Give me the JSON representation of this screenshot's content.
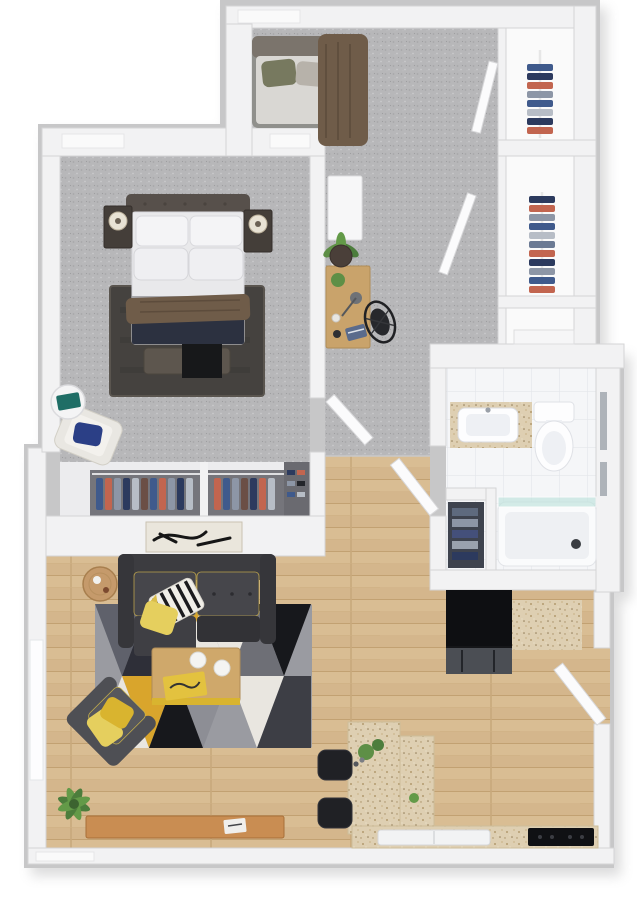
{
  "scene": {
    "title": "3D Floor Plan - One-Bedroom Apartment (top-down dollhouse render)",
    "style": "photoreal 3D top view, white cut walls with gray rim, no text labels visible",
    "background": "#ffffff"
  },
  "palette": {
    "outer_wall": "#c7c7c8",
    "wall": "#f2f2f3",
    "wall_edge": "#d4d4d6",
    "carpet": "#b7b7b9",
    "wood_floor": "#d9bd93",
    "tile": "#f5f6f8",
    "granite": "#decfb2",
    "sofa": "#3c3c40",
    "armchair_gray": "#4e4f54",
    "accent_yellow": "#d9b42f",
    "pillow_yellow": "#e5cf5e",
    "rug_gray": "#9a9ba1",
    "rug_dark": "#5f616b",
    "rug_black": "#17181c",
    "rug_white": "#e9e6e0",
    "navy": "#2c3140",
    "headboard": "#57504b",
    "bed_throw": "#6f5c49",
    "appliance_black": "#151619",
    "stool_black": "#202125",
    "plant_green": "#5e8f46",
    "clothes_blue": "#3f5a8c",
    "clothes_red": "#c2654f",
    "clothes_gray": "#8d96a6",
    "pillow_navy": "#2b3f86",
    "glass": "#bfe3dd",
    "wood_furniture": "#c9a36b",
    "console_wood": "#c98d52"
  },
  "rooms": [
    {
      "id": "bedroom",
      "name": "Bedroom",
      "floor": "gray carpet",
      "furniture": [
        "double bed with tufted headboard, four white pillows, gray band and dark navy blanket",
        "brown throw blanket across bed",
        "upholstered bench with black runner at foot of bed",
        "dark area rug under bed",
        "left nightstand with basket lamp",
        "right nightstand with basket lamp",
        "cream accent chair with navy pillow",
        "round white side table with teal book"
      ]
    },
    {
      "id": "den",
      "name": "Den / Home Office",
      "floor": "gray carpet",
      "furniture": [
        "daybed with olive and gray pillows and brown draped blanket",
        "white storage cabinet",
        "potted plant",
        "wooden desk with task lamp, plant, mug and book",
        "black wire desk chair",
        "round dark stool cushion"
      ]
    },
    {
      "id": "hall-closets",
      "name": "Hallway Closets",
      "floor": "white",
      "furniture": [
        "upper closet with hanging clothes on rod",
        "middle closet with hanging clothes on rod",
        "small lower closet with shelf unit"
      ]
    },
    {
      "id": "bedroom-closet",
      "name": "Bedroom Wardrobe",
      "floor": "white",
      "furniture": [
        "two sliding sections of hanging clothes",
        "shoe nook with small shelves"
      ]
    },
    {
      "id": "bathroom",
      "name": "Bathroom",
      "floor": "white tile",
      "furniture": [
        "vanity with granite top and white sink",
        "toilet",
        "bathtub with glass screen",
        "linen closet with folded towels"
      ]
    },
    {
      "id": "living",
      "name": "Living Room",
      "floor": "light wood planks",
      "furniture": [
        "charcoal two-seat sofa with chaise and yellow piping",
        "black-white striped pillow with yellow trim",
        "plain yellow pillow",
        "black and white abstract wall art",
        "round wooden side table",
        "geometric triangle rug in yellow, black, gray and white",
        "wooden coffee table with two plates and yellow book",
        "dark gray angled armchair with two yellow pillows",
        "corner fern plant",
        "low wooden console bench with book"
      ]
    },
    {
      "id": "kitchen",
      "name": "Kitchen",
      "floor": "light wood planks",
      "furniture": [
        "black refrigerator with stainless lower drawers",
        "granite counter beside fridge",
        "L-shaped granite breakfast bar with small plants and bottles",
        "two black tufted bar stools",
        "granite counter along bottom wall with white sink",
        "black cooktop",
        "open white entry door"
      ]
    }
  ],
  "doors": [
    "bedroom door (open into hall)",
    "bathroom door (open into hall)",
    "upper closet door (open)",
    "middle closet door (open)",
    "apartment entry door (open into kitchen)"
  ],
  "windows": [
    "den top-wall recess",
    "bedroom top-wall recesses (left and right)",
    "living-room left-wall window",
    "bathroom right-wall slit windows",
    "bottom-left wall recess"
  ]
}
